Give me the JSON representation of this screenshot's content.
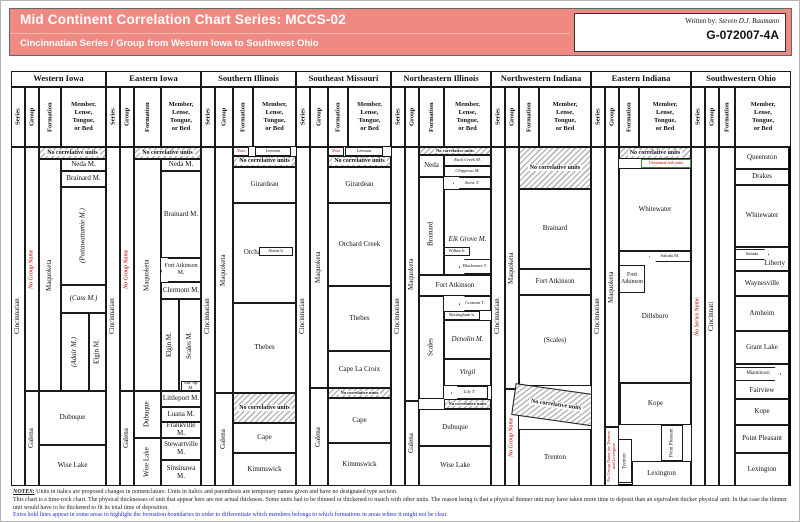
{
  "header": {
    "title": "Mid Continent Correlation Chart Series: MCCS-02",
    "subtitle": "Cincinnatian Series / Group from Western Iowa to Southwest Ohio",
    "written_by_label": "Written by:",
    "author": "Steven D.J. Baumann",
    "doc_id": "G-072007-4A",
    "accent_color": "#ee8a82"
  },
  "subheader": {
    "series": "Series",
    "group": "Group",
    "formation": "Formation",
    "member": "Member,\nLense,\nTongue,\nor Bed"
  },
  "no_corr": "No correlative units",
  "columns": [
    {
      "name": "Western Iowa",
      "series": "Cincinnatian",
      "group_upper": "No Group Name",
      "group_lower": "Galena",
      "formation": "Maquoketa",
      "units": {
        "neda": "Neda M.",
        "brainard": "Brainard M.",
        "pottawattamie": "(Pottawattamie M.)",
        "cass": "(Cass M.)",
        "adair": "(Adair M.)",
        "elgin": "Elgin M.",
        "dubuque": "Dubuque",
        "wise_lake": "Wise Lake"
      }
    },
    {
      "name": "Eastern Iowa",
      "series": "Cincinnatian",
      "group_upper": "No Group Name",
      "group_lower": "Galena",
      "formation": "Maquoketa",
      "formation_dubuque": "Dubuque",
      "formation_wise_lake": "Wise Lake",
      "units": {
        "neda": "Neda M.",
        "brainard": "Brainard M.",
        "fort_atkinson": "Fort Atkinson M.",
        "clermont": "Clermont M.",
        "elgin": "Elgin M.",
        "scales": "Scales M.",
        "am_sp": "Am. Sp. M.",
        "littleport": "Littleport M.",
        "luana": "Luana M.",
        "frankville": "Frankville M.",
        "stewartville": "Stewartville M.",
        "sinsinawa": "Sinsinawa M."
      }
    },
    {
      "name": "Southern Illinois",
      "series": "Cincinnatian",
      "group_upper": "Maquoketa",
      "group_lower": "Galena",
      "units": {
        "noix": "Noix",
        "leemon": "Leemon",
        "girardeau": "Girardeau",
        "orchard_creek": "Orchard Creek",
        "ahern": "Ahern b.",
        "thebes": "Thebes",
        "cape": "Cape",
        "kimmswick": "Kimmswick"
      }
    },
    {
      "name": "Southeast Missouri",
      "series": "Cincinnatian",
      "group_upper": "Maquoketa",
      "group_lower": "Galena",
      "units": {
        "noix": "Noix",
        "leemon": "Leemon",
        "girardeau": "Girardeau",
        "orchard_creek": "Orchard Creek",
        "thebes": "Thebes",
        "cape_la_croix": "Cape La Croix",
        "cape": "Cape",
        "kimmswick": "Kimmswick"
      }
    },
    {
      "name": "Northeastern Illinois",
      "series": "Cincinnatian",
      "group_upper": "Maquoketa",
      "group_lower": "Galena",
      "formations": {
        "neda": "Neda",
        "brainard": "Brainard",
        "fort_atkinson": "Fort Atkinson",
        "scales": "Scales",
        "dubuque": "Dubuque",
        "wise_lake": "Wise Lake"
      },
      "units": {
        "rock_creek": "Rock Creek M.",
        "chippewa": "Chippewa M.",
        "stone_t": "Stone T.",
        "elk_grove": "Elk Grove M.",
        "wilbur": "Wilbur b.",
        "blackmore": "Blackmore T.",
        "cronson": "Cronson T.",
        "rottingham": "Rottingham b.",
        "denolin": "Denolin M.",
        "virgil": "Virgil",
        "lily": "Lily T."
      }
    },
    {
      "name": "Northwestern Indiana",
      "series": "Cincinnatian",
      "group_upper": "Maquoketa",
      "group_lower": "No Group Name",
      "units": {
        "brainard": "Brainard",
        "fort_atkinson": "Fort Atkinson",
        "scales": "(Scales)",
        "trenton": "Trenton"
      }
    },
    {
      "name": "Eastern Indiana",
      "series": "Cincinnatian",
      "group_upper": "Maquoketa",
      "group_lower": "No Group Name for Trenton and Lexington",
      "units": {
        "unnamed_red": "Unnamed red units",
        "whitewater": "Whitewater",
        "saluda": "Saluda M.",
        "fort_atkinson": "Fort Atkinson",
        "dillsboro": "Dillsboro",
        "kope": "Kope",
        "trenton": "Trenton",
        "point_pleasant": "Point Pleasant",
        "lexington": "Lexington"
      }
    },
    {
      "name": "Southwestern Ohio",
      "series": "No Series Name",
      "group": "Cincinnati",
      "units": {
        "queenston": "Queenston",
        "drakes": "Drakes",
        "whitewater": "Whitewater",
        "saluda": "Saluda",
        "liberty": "Liberty",
        "waynesville": "Waynesville",
        "arnheim": "Arnheim",
        "grant_lake": "Grant Lake",
        "miamitown": "Miamitown",
        "fairview": "Fairview",
        "kope": "Kope",
        "point_pleasant": "Point Pleasant",
        "lexington": "Lexington"
      }
    }
  ],
  "notes": {
    "label": "NOTES:",
    "line1": "Units in italics are proposed changes in nomenclature.  Units in italics and parenthesis are temporary names given and have no designated type section.",
    "line2": "This chart is a time-rock chart.  The physical thicknesses of unit that appear here are not actual thickness.  Some units had to be thinned or thickened to match with other units.  The reason being is that a physical thinner unit may have taken more time to deposit than an equivalent thicker physical unit.  In that case the thinner unit would have to be thickened to fit its total time of deposition.",
    "line3": "Extra bold lines appear in some areas to highlight the formation boundaries in order to differentiate which members belongs to which formations in areas where it might not be clear."
  }
}
